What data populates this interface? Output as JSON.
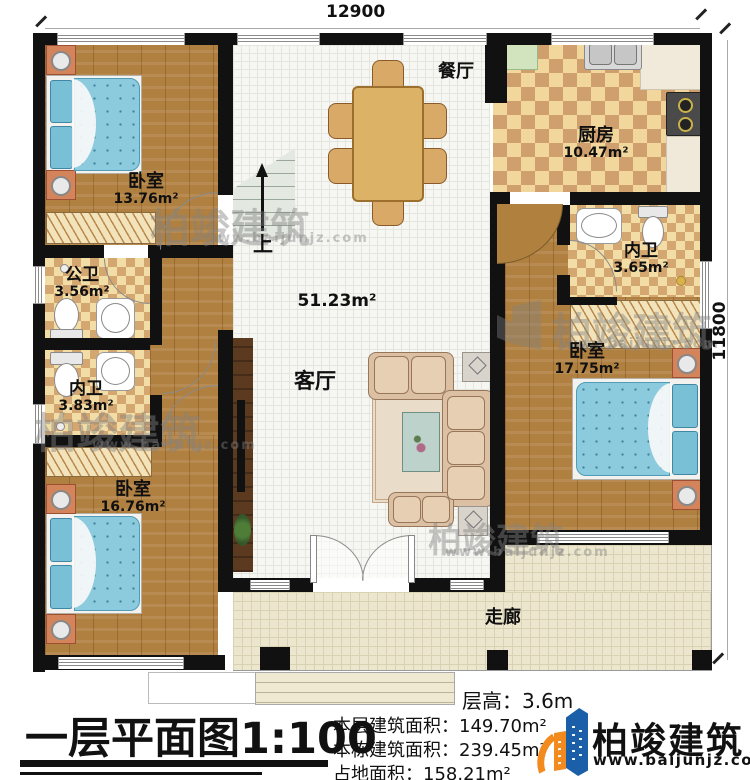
{
  "dimensions": {
    "width_top": "12900",
    "height_right": "11800"
  },
  "rooms": {
    "bedroom_top_left": {
      "name": "卧室",
      "area": "13.76m²"
    },
    "bedroom_bottom_left": {
      "name": "卧室",
      "area": "16.76m²"
    },
    "bedroom_right": {
      "name": "卧室",
      "area": "17.75m²"
    },
    "dining": {
      "name": "餐厅"
    },
    "kitchen": {
      "name": "厨房",
      "area": "10.47m²"
    },
    "living": {
      "name": "客厅",
      "area": "51.23m²"
    },
    "public_bathroom": {
      "name": "公卫",
      "area": "3.56m²"
    },
    "ensuite_left": {
      "name": "内卫",
      "area": "3.83m²"
    },
    "ensuite_right": {
      "name": "内卫",
      "area": "3.65m²"
    },
    "corridor": {
      "name": "走廊"
    },
    "stairs": {
      "label": "上"
    }
  },
  "footer": {
    "title": "一层平面图",
    "scale": "1:100",
    "stats": {
      "floor_height": {
        "label": "层高：",
        "value": "3.6m"
      },
      "floor_area": {
        "label": "本层建筑面积：",
        "value": "149.70m²"
      },
      "total_area": {
        "label": "本栋建筑面积：",
        "value": "239.45m²"
      },
      "land_area": {
        "label": "占地面积：",
        "value": "158.21m²"
      }
    }
  },
  "brand": {
    "name": "柏竣建筑",
    "website": "www.baijunjz.com"
  },
  "watermark": {
    "name": "柏竣建筑",
    "website": "www.baijunjz.com"
  },
  "colors": {
    "wall": "#111111",
    "wood": "#b08040",
    "tile_light": "#f2d79c",
    "tile_dark": "#cfa06d",
    "grid_floor": "#f6f6f3",
    "corridor": "#ece6ce",
    "bed": "#8ccadd",
    "sofa": "#dcc0a4",
    "stairs": "#e3e8e0",
    "brand_blue": "#1a5fa8",
    "brand_orange": "#f28a1e"
  }
}
